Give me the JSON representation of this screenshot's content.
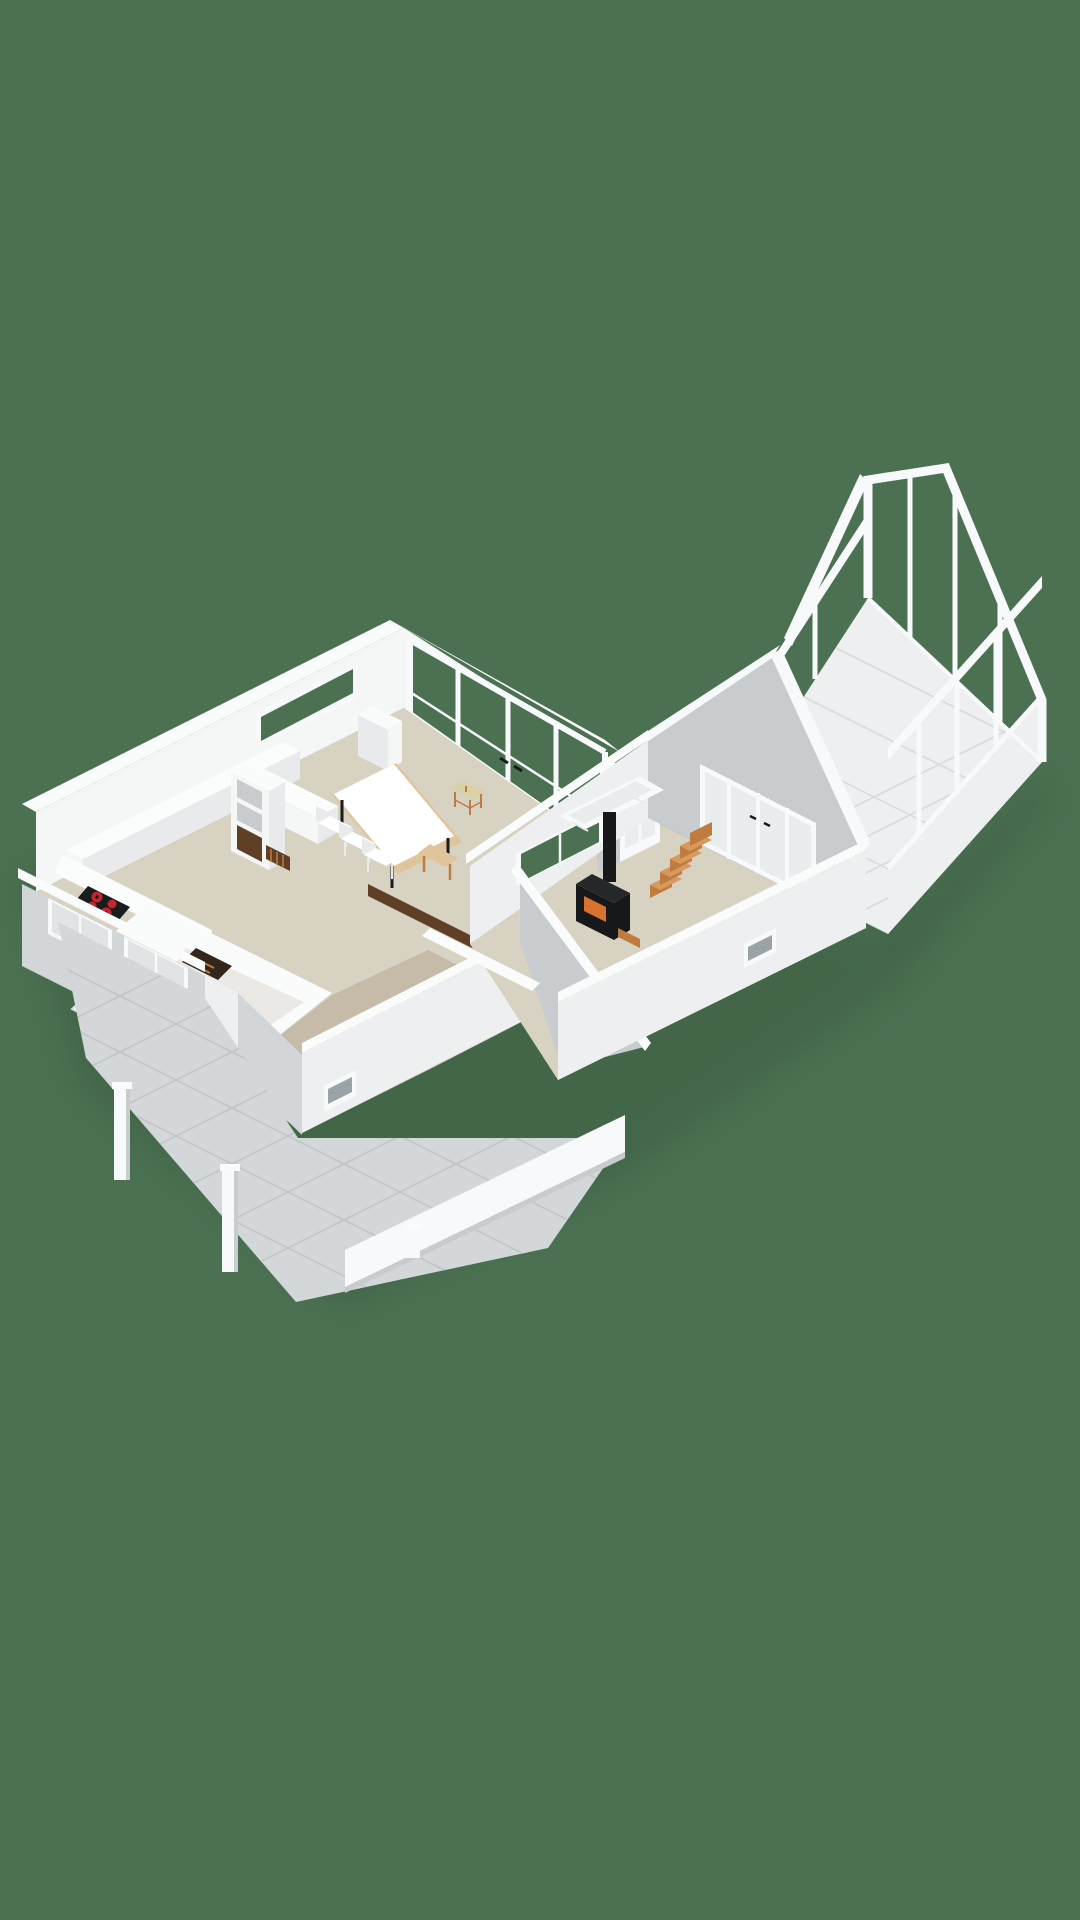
{
  "meta": {
    "description": "3D isometric floor-plan rendering of a single-storey house on a plain green background: open kitchen and dining room with glass window wall, hallway with bathroom block, living room with wood-burning stove and stairs, glass conservatory on the right and a tiled terrace with pergola posts at the lower left.",
    "canvas": {
      "width": 1080,
      "height": 1920
    }
  },
  "colors": {
    "bg": "#4b7152",
    "shadow": "#3a5a41",
    "wallTop": "#fafbfb",
    "wallInner": "#f5f6f6",
    "wallFaceSW": "#d3d6d8",
    "wallFaceSE": "#edeff0",
    "wallGray": "#c8ccce",
    "floorMain": "#d8d2c3",
    "floorHall": "#c6bba8",
    "floorPale": "#eae9e5",
    "tile": "#edeff0",
    "tileLine": "#d9dcde",
    "terrace": "#d4d7d9",
    "terraceLine": "#c3c7ca",
    "frame": "#f8f9fa",
    "glassSW": "#e0e4e5",
    "paneLight": "#e9edee",
    "counter": "#fbfcfc",
    "counterSide": "#e8eaeb",
    "cooktop": "#1a1b1d",
    "burner": "#c1272d",
    "stove": "#26272a",
    "stoveDark": "#17181a",
    "fire": "#d9722f",
    "wood": "#e0c49c",
    "tread": "#d9995c",
    "riser": "#bf7c41",
    "radiator": "#5f4026",
    "wardrobe": "#33261c",
    "sofa": "#ced5d8",
    "sofaSide": "#b7bec2",
    "wicker": "#d9d1a8",
    "darkWindow": "#9aa3a6"
  },
  "scene": {
    "rooms": [
      {
        "name": "kitchen"
      },
      {
        "name": "dining-area"
      },
      {
        "name": "hallway"
      },
      {
        "name": "bathroom"
      },
      {
        "name": "living-room"
      },
      {
        "name": "conservatory"
      },
      {
        "name": "terrace"
      }
    ],
    "furniture": [
      {
        "name": "kitchen-counter-l-shape"
      },
      {
        "name": "induction-cooktop-4-burners"
      },
      {
        "name": "kitchen-island"
      },
      {
        "name": "open-shelving-unit"
      },
      {
        "name": "kitchen-radiator"
      },
      {
        "name": "dark-wardrobe"
      },
      {
        "name": "bathtub"
      },
      {
        "name": "toilet"
      },
      {
        "name": "dining-table"
      },
      {
        "name": "dining-bench"
      },
      {
        "name": "dining-chairs",
        "count": 3
      },
      {
        "name": "wicker-stool"
      },
      {
        "name": "chest-of-drawers"
      },
      {
        "name": "dining-radiator"
      },
      {
        "name": "wood-stove-with-flue"
      },
      {
        "name": "firewood"
      },
      {
        "name": "staircase"
      },
      {
        "name": "sofa"
      },
      {
        "name": "side-table"
      },
      {
        "name": "pergola-posts",
        "count": 3
      }
    ]
  }
}
